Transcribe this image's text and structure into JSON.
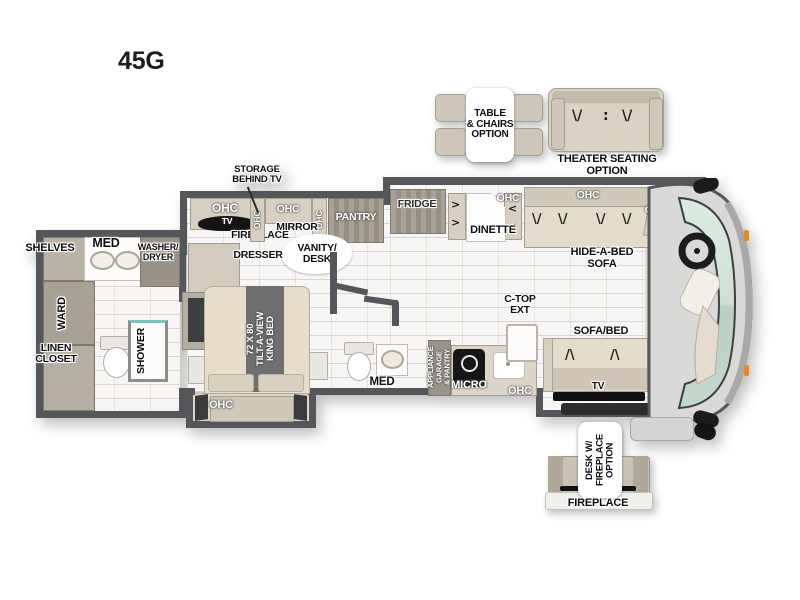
{
  "title": "45G",
  "icons": {
    "seat_v": "\\/",
    "seat_a": "/\\",
    "dots": ":",
    "chev_r": ">",
    "chev_l": "<"
  },
  "colors": {
    "wall": "#55565a",
    "cabinet": "#d7d0c2",
    "cabinet_dark": "#a29b90",
    "glass": "#cfe1d7",
    "floor": "#f7f6f4",
    "accent": "#1a1a1a"
  },
  "options": {
    "table_chairs": {
      "l1": "TABLE",
      "l2": "& CHAIRS",
      "l3": "OPTION"
    },
    "theater": {
      "l1": "THEATER SEATING",
      "l2": "OPTION"
    },
    "desk": {
      "l1": "DESK W/",
      "l2": "FIREPLACE",
      "l3": "OPTION"
    },
    "fireplace": "FIREPLACE"
  },
  "rear_bath": {
    "shelves": "SHELVES",
    "med": "MED",
    "washer_dryer": {
      "l1": "WASHER/",
      "l2": "DRYER"
    },
    "ward": "WARD",
    "linen": {
      "l1": "LINEN",
      "l2": "CLOSET"
    },
    "shower": "SHOWER"
  },
  "bedroom": {
    "storage": {
      "l1": "STORAGE",
      "l2": "BEHIND TV"
    },
    "ohc_top": "OHC",
    "tv": "TV",
    "fireplace": "FIREPLACE",
    "ohc_v1": "OHC",
    "ohc_mid": "OHC",
    "ohc_v2": "OHC",
    "mirror": "MIRROR",
    "pantry": "PANTRY",
    "vanity": {
      "l1": "VANITY/",
      "l2": "DESK"
    },
    "dresser": "DRESSER",
    "bed": {
      "l1": "72 X 80",
      "l2": "TILT-A-VIEW",
      "l3": "KING BED"
    },
    "ohc_bed": "OHC"
  },
  "mid_bath": {
    "med": "MED"
  },
  "kitchen": {
    "appliance": {
      "l1": "APPLIANCE",
      "l2": "GARAGE",
      "l3": "& PANTRY"
    },
    "micro": "MICRO",
    "ohc": "OHC",
    "ctop": {
      "l1": "C-TOP",
      "l2": "EXT"
    }
  },
  "living": {
    "fridge": "FRIDGE",
    "dinette": "DINETTE",
    "ohc_1": "OHC",
    "ohc_2": "OHC",
    "ohc_3": "OHC",
    "hide_a_bed": {
      "l1": "HIDE-A-BED",
      "l2": "SOFA"
    },
    "sofa_bed": "SOFA/BED",
    "tv": "TV"
  },
  "cockpit": {
    "ohc_top": "OHC",
    "bed": {
      "l1": "COCKPIT",
      "l2": "BED"
    },
    "entry": "ENTRY",
    "ohc_entry": "OHC"
  }
}
